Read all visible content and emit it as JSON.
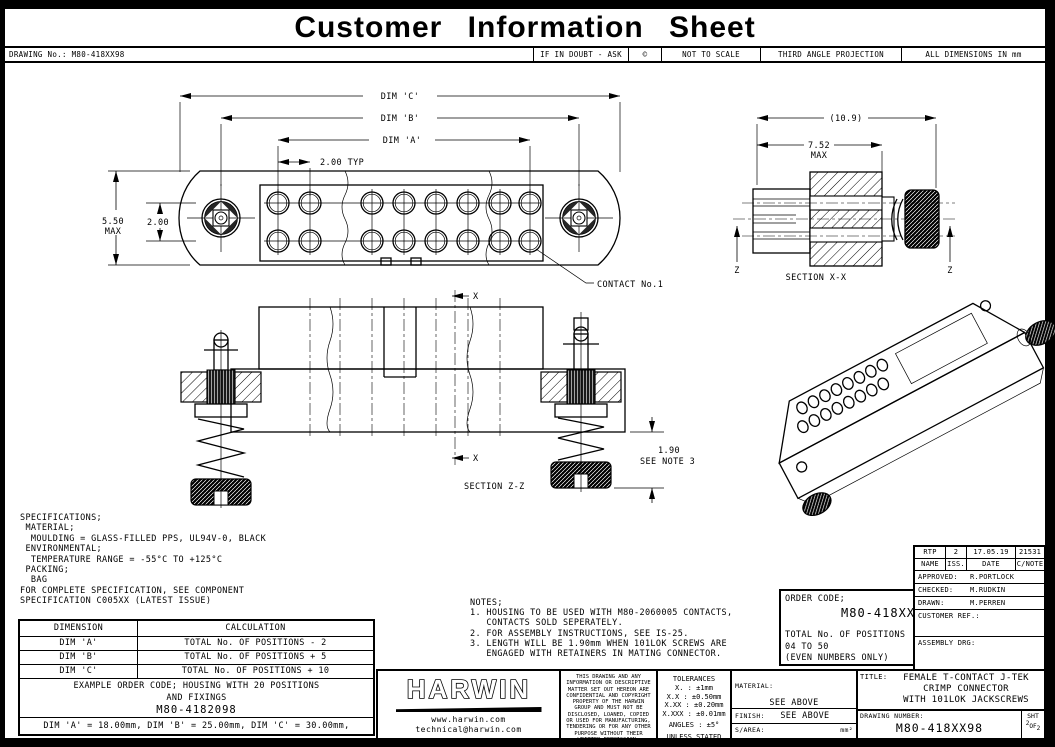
{
  "page": {
    "title": "Customer Information Sheet"
  },
  "info_bar": {
    "drawing_no": "DRAWING No.: M80-418XX98",
    "if_in_doubt": "IF IN DOUBT - ASK",
    "copyright": "©",
    "not_to_scale": "NOT TO SCALE",
    "projection": "THIRD ANGLE PROJECTION",
    "units_note": "ALL DIMENSIONS IN mm"
  },
  "labels": {
    "dim_c": "DIM 'C'",
    "dim_b": "DIM 'B'",
    "dim_a": "DIM 'A'",
    "pitch": "2.00 TYP",
    "height": "5.50",
    "max": "MAX",
    "row_pitch": "2.00",
    "contact": "CONTACT No.1",
    "overall": "(10.9)",
    "depth": "7.52",
    "section_xx": "SECTION X-X",
    "z": "Z",
    "x": "X",
    "section_zz": "SECTION Z-Z",
    "protrusion": "1.90",
    "protrusion_note": "SEE NOTE 3"
  },
  "specifications": {
    "text": "SPECIFICATIONS;\n MATERIAL;\n  MOULDING = GLASS-FILLED PPS, UL94V-0, BLACK\n ENVIRONMENTAL;\n  TEMPERATURE RANGE = -55°C TO +125°C\n PACKING;\n  BAG\nFOR COMPLETE SPECIFICATION, SEE COMPONENT\nSPECIFICATION C005XX (LATEST ISSUE)"
  },
  "dimension_table": {
    "col1_header": "DIMENSION",
    "col2_header": "CALCULATION",
    "rows": [
      {
        "dim": "DIM 'A'",
        "calc": "TOTAL No. OF POSITIONS - 2"
      },
      {
        "dim": "DIM 'B'",
        "calc": "TOTAL No. OF POSITIONS + 5"
      },
      {
        "dim": "DIM 'C'",
        "calc": "TOTAL No. OF POSITIONS + 10"
      }
    ],
    "example_title": "EXAMPLE ORDER CODE; HOUSING WITH 20 POSITIONS",
    "example_title2": "AND FIXINGS",
    "example_code": "M80-4182098",
    "example_dims": "DIM 'A' = 18.00mm, DIM 'B' = 25.00mm, DIM 'C' = 30.00mm,"
  },
  "notes": {
    "text": "NOTES;\n1. HOUSING TO BE USED WITH M80-2060005 CONTACTS,\n   CONTACTS SOLD SEPERATELY.\n2. FOR ASSEMBLY INSTRUCTIONS, SEE IS-25.\n3. LENGTH WILL BE 1.90mm WHEN 101LOK SCREWS ARE\n   ENGAGED WITH RETAINERS IN MATING CONNECTOR."
  },
  "order_code": {
    "label": "ORDER CODE;",
    "code": "M80-418XX98",
    "positions_label": "TOTAL No. OF POSITIONS",
    "positions_range": "04 TO 50",
    "positions_note": "(EVEN NUMBERS ONLY)"
  },
  "revision_block": {
    "name": "RTP",
    "issue": "2",
    "date": "17.05.19",
    "change_note": "21531",
    "h_name": "NAME",
    "h_issue": "ISS.",
    "h_date": "DATE",
    "h_cnote": "C/NOTE",
    "approved_label": "APPROVED:",
    "approved": "R.PORTLOCK",
    "checked_label": "CHECKED:",
    "checked": "M.RUDKIN",
    "drawn_label": "DRAWN:",
    "drawn": "M.PERREN",
    "customer_ref_label": "CUSTOMER REF.:",
    "assembly_drg_label": "ASSEMBLY DRG:"
  },
  "title_block": {
    "brand": "HARWIN",
    "website": "www.harwin.com",
    "email": "technical@harwin.com",
    "confidential": "THIS DRAWING AND ANY INFORMATION OR DESCRIPTIVE MATTER SET OUT HEREON ARE CONFIDENTIAL AND COPYRIGHT PROPERTY OF THE HARWIN GROUP AND MUST NOT BE DISCLOSED, LOANED, COPIED OR USED FOR MANUFACTURING, TENDERING OR FOR ANY OTHER PURPOSE WITHOUT THEIR WRITTEN PERMISSION.",
    "tolerances_title": "TOLERANCES",
    "tolerances": "X. : ±1mm\nX.X : ±0.50mm\nX.XX : ±0.20mm\nX.XXX : ±0.01mm",
    "angles": "ANGLES : ±5°",
    "unless": "UNLESS STATED",
    "material_label": "MATERIAL:",
    "material": "SEE ABOVE",
    "finish_label": "FINISH:",
    "finish": "SEE ABOVE",
    "sarea_label": "S/AREA:",
    "sarea_unit": "mm²",
    "title_label": "TITLE:",
    "title_line1": "FEMALE T-CONTACT J-TEK",
    "title_line2": "CRIMP CONNECTOR",
    "title_line3": "WITH 101LOK JACKSCREWS",
    "drawing_number_label": "DRAWING NUMBER:",
    "drawing_number": "M80-418XX98",
    "sheet_label": "SHT",
    "sheet_no": "2",
    "sheet_of": "OF",
    "sheet_total": "2"
  }
}
